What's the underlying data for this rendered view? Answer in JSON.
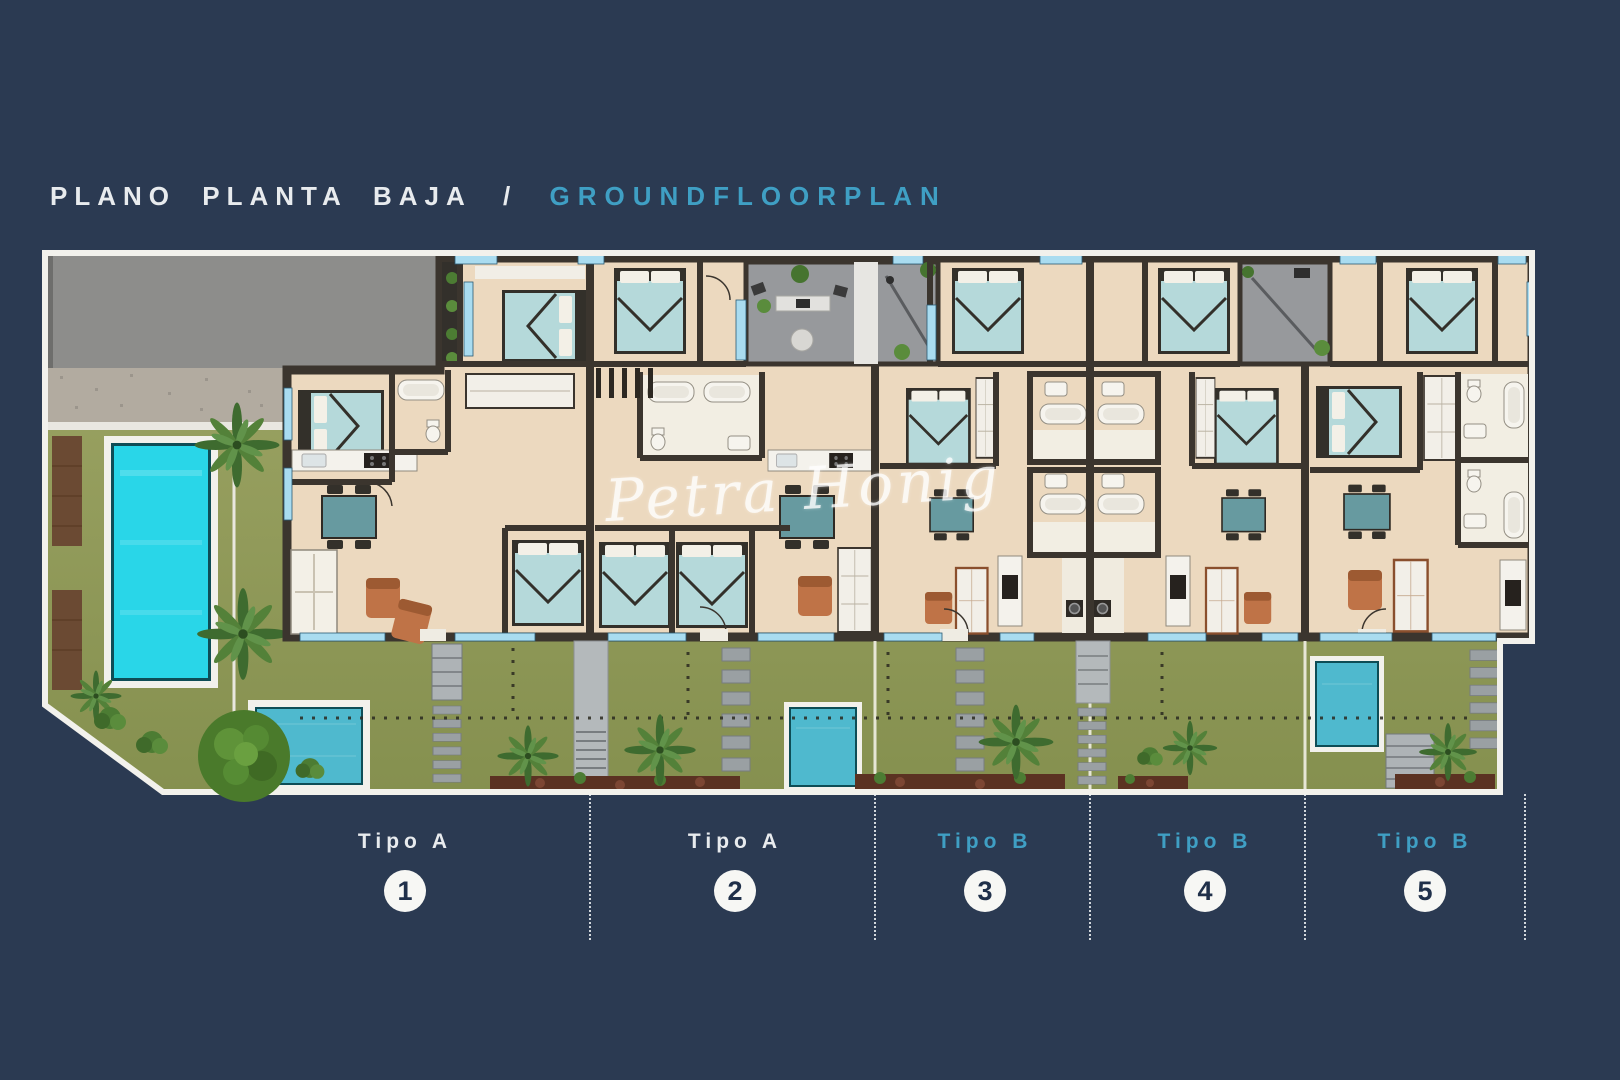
{
  "header": {
    "title_primary": "PLANO PLANTA BAJA",
    "title_separator": "/",
    "title_secondary": "GROUNDFLOORPLAN"
  },
  "watermark": {
    "text": "Petra Honig"
  },
  "plan": {
    "units": [
      {
        "type_label": "Tipo A",
        "number": "1",
        "type": "A"
      },
      {
        "type_label": "Tipo A",
        "number": "2",
        "type": "A"
      },
      {
        "type_label": "Tipo B",
        "number": "3",
        "type": "B"
      },
      {
        "type_label": "Tipo B",
        "number": "4",
        "type": "B"
      },
      {
        "type_label": "Tipo B",
        "number": "5",
        "type": "B"
      }
    ]
  },
  "colors": {
    "background": "#2b3a52",
    "title_primary": "#e8ebee",
    "accent_teal": "#3f9fc4",
    "tipo_a_label": "#e8ebee",
    "tipo_b_label": "#3f9fc4",
    "label_circle_fill": "#f7f7f4",
    "label_number": "#20304a",
    "plan_border": "#f2f1ec",
    "road_gray": "#8d8d8b",
    "garden_green": "#9aa262",
    "garden_green_dark": "#85904f",
    "pool_cyan": "#29d6e8",
    "small_pool_teal": "#4fb9ce",
    "building_floor": "#ecd9bf",
    "wall_dark": "#3b352e",
    "window_blue": "#a9dcf0",
    "courtyard_gray": "#97999c",
    "furniture_teal": "#679aa0",
    "bed_teal": "#b5d9da",
    "terracotta": "#bf7347",
    "stone_gray": "#9aa0a3",
    "mulch_brown": "#5b3222",
    "palm_green": "#46742f",
    "watermark_color": "#ffffff"
  }
}
